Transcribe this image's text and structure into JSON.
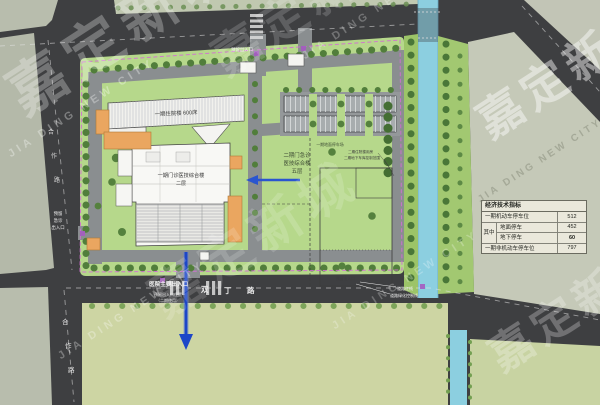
{
  "watermark": {
    "cn": "嘉定新城",
    "en": "JIA DING NEW CITY"
  },
  "roads": {
    "bottom_name_chars": [
      "双",
      "丁",
      "路"
    ],
    "west_name_chars": [
      "合",
      "作",
      "路"
    ]
  },
  "buildings": {
    "inpatient": {
      "label": "一期住院楼 600床"
    },
    "outpatient": {
      "line1": "一期门诊医技综合楼",
      "line2": "二层"
    },
    "phase2": {
      "line1": "二期门急诊",
      "line2": "医技综合楼",
      "line3": "五层"
    },
    "phase2_notes": {
      "line1": "二期住院楼用房",
      "line2": "二期地下车库控制范围"
    },
    "parking_label": "一期地面停车场"
  },
  "entrances": {
    "main": {
      "label": "医院主要出入口",
      "note1": "预留出入口位置",
      "note2": "（二期使用）"
    },
    "emergency": {
      "line1": "预留",
      "line2": "急诊",
      "line3": "出入口"
    },
    "north": {
      "label": "预留出入口"
    },
    "south_reserved": {
      "label": "预留出入口"
    }
  },
  "annotations": {
    "red_line": "道路红线",
    "green_line": "道路绿化控制线"
  },
  "legend": {
    "title": "经济技术指标",
    "row1_label": "一期机动车停车位",
    "row1_value": "512",
    "group_label": "其中",
    "row2_label": "地面停车",
    "row2_value": "452",
    "row3_label": "地下停车",
    "row3_value": "60",
    "row4_label": "一期非机动车停车位",
    "row4_value": "797"
  },
  "colors": {
    "road_dark": "#3e3f41",
    "site_green": "#b6d88b",
    "canal_blue": "#8ccfe0",
    "boundary_pink": "#d26fd3",
    "arrow_blue": "#1c46c8",
    "building_orange": "#eaa660"
  }
}
